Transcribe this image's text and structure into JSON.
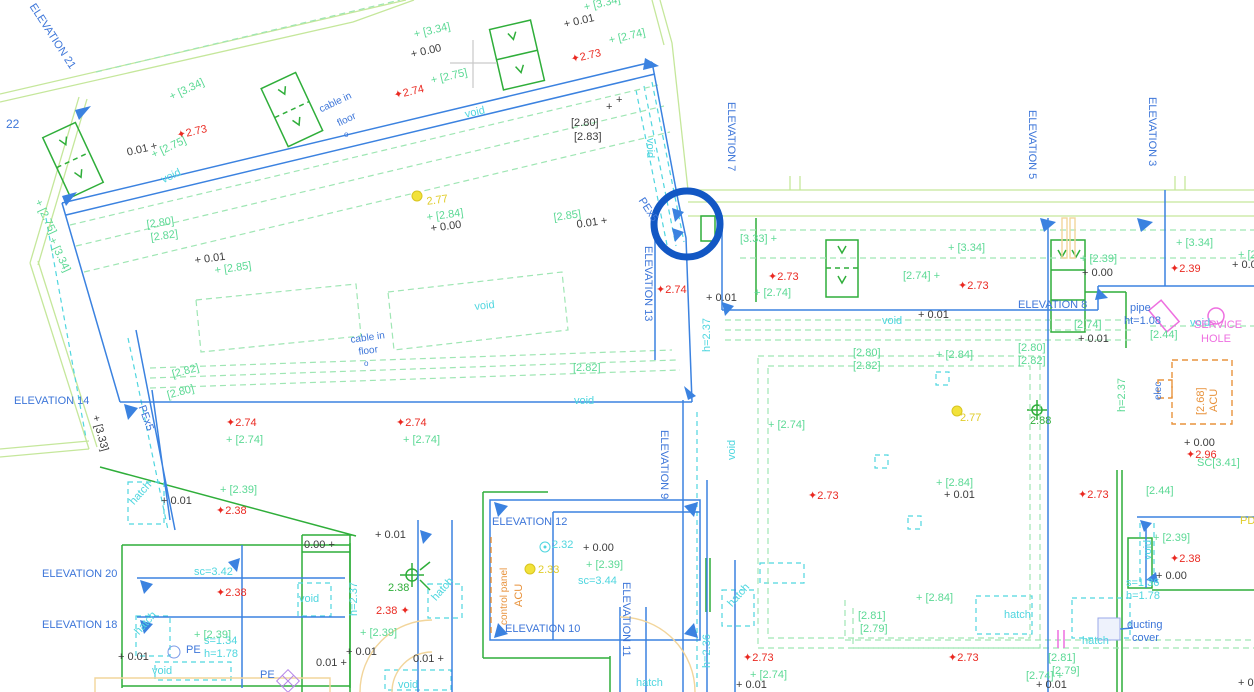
{
  "palette": {
    "blue": "#3d76d9",
    "cyan": "#4fd6df",
    "green": "#5cd995",
    "dgreen": "#2fae3a",
    "red": "#ea2a22",
    "yellow": "#e0cc28",
    "black": "#3c3c3c",
    "orange": "#e8933d",
    "pink": "#ee6fe0",
    "gray": "#c9c9c9",
    "tan": "#f2d59b",
    "wall": "#c5e79b",
    "gdash": "#9fe6b4",
    "line": "#3b82e0",
    "highlight": "#1257c4"
  },
  "drawing": {
    "type": "cad-floor-plan",
    "highlight_circle": {
      "x": 687,
      "y": 224,
      "r": 33,
      "color": "#1257c4",
      "stroke_width": 7
    },
    "labels": [
      {
        "t": "ELEVATION 21",
        "x": 36,
        "y": 2,
        "c": "blue",
        "r": 57
      },
      {
        "t": "22",
        "x": 6,
        "y": 118,
        "c": "blue",
        "s": 12
      },
      {
        "t": "ELEVATION 7",
        "x": 736,
        "y": 102,
        "c": "blue",
        "r": 90
      },
      {
        "t": "ELEVATION 13",
        "x": 653,
        "y": 246,
        "c": "blue",
        "r": 90
      },
      {
        "t": "ELEVATION 14",
        "x": 14,
        "y": 396,
        "c": "blue"
      },
      {
        "t": "ELEVATION 5",
        "x": 1037,
        "y": 110,
        "c": "blue",
        "r": 90
      },
      {
        "t": "ELEVATION 3",
        "x": 1157,
        "y": 97,
        "c": "blue",
        "r": 90
      },
      {
        "t": "ELEVATION 8",
        "x": 1018,
        "y": 300,
        "c": "blue"
      },
      {
        "t": "ELEVATION 9",
        "x": 669,
        "y": 430,
        "c": "blue",
        "r": 90
      },
      {
        "t": "ELEVATION 12",
        "x": 492,
        "y": 517,
        "c": "blue"
      },
      {
        "t": "ELEVATION 11",
        "x": 631,
        "y": 582,
        "c": "blue",
        "r": 90
      },
      {
        "t": "ELEVATION 10",
        "x": 505,
        "y": 624,
        "c": "blue"
      },
      {
        "t": "ELEVATION 20",
        "x": 42,
        "y": 569,
        "c": "blue"
      },
      {
        "t": "ELEVATION 18",
        "x": 42,
        "y": 620,
        "c": "blue"
      },
      {
        "t": "PEx5",
        "x": 645,
        "y": 196,
        "c": "blue",
        "r": 57
      },
      {
        "t": "PEx5",
        "x": 146,
        "y": 404,
        "c": "blue",
        "r": 70
      },
      {
        "t": "pipe",
        "x": 1130,
        "y": 303,
        "c": "blue"
      },
      {
        "t": "ht=1.08",
        "x": 1124,
        "y": 316,
        "c": "blue"
      },
      {
        "t": "cable in",
        "x": 318,
        "y": 106,
        "c": "blue",
        "r": -25,
        "s": 10
      },
      {
        "t": "floor",
        "x": 336,
        "y": 120,
        "c": "blue",
        "r": -25,
        "s": 10
      },
      {
        "t": "o",
        "x": 344,
        "y": 131,
        "c": "blue",
        "s": 8
      },
      {
        "t": "cable in",
        "x": 350,
        "y": 336,
        "c": "blue",
        "r": -8,
        "s": 10
      },
      {
        "t": "floor",
        "x": 358,
        "y": 348,
        "c": "blue",
        "r": -8,
        "s": 10
      },
      {
        "t": "o",
        "x": 364,
        "y": 360,
        "c": "blue",
        "s": 8
      },
      {
        "t": "ducting",
        "x": 1127,
        "y": 620,
        "c": "blue"
      },
      {
        "t": "cover",
        "x": 1132,
        "y": 633,
        "c": "blue"
      },
      {
        "t": "PE",
        "x": 186,
        "y": 645,
        "c": "blue"
      },
      {
        "t": "PE",
        "x": 260,
        "y": 670,
        "c": "blue"
      },
      {
        "t": "elec",
        "x": 1154,
        "y": 400,
        "c": "blue",
        "r": -90,
        "s": 10
      },
      {
        "t": "PD",
        "x": 1240,
        "y": 516,
        "c": "yellow"
      },
      {
        "t": "void",
        "x": 160,
        "y": 176,
        "c": "cyan",
        "r": -25
      },
      {
        "t": "void",
        "x": 464,
        "y": 110,
        "c": "cyan",
        "r": -13
      },
      {
        "t": "void",
        "x": 655,
        "y": 138,
        "c": "cyan",
        "r": 90
      },
      {
        "t": "void",
        "x": 474,
        "y": 302,
        "c": "cyan",
        "r": -6
      },
      {
        "t": "void",
        "x": 574,
        "y": 396,
        "c": "cyan"
      },
      {
        "t": "void",
        "x": 882,
        "y": 316,
        "c": "cyan"
      },
      {
        "t": "void",
        "x": 1190,
        "y": 318,
        "c": "cyan"
      },
      {
        "t": "void",
        "x": 727,
        "y": 460,
        "c": "cyan",
        "r": -90
      },
      {
        "t": "void",
        "x": 299,
        "y": 594,
        "c": "cyan"
      },
      {
        "t": "void",
        "x": 152,
        "y": 666,
        "c": "cyan"
      },
      {
        "t": "void",
        "x": 398,
        "y": 680,
        "c": "cyan"
      },
      {
        "t": "void",
        "x": 1143,
        "y": 560,
        "c": "cyan",
        "r": -90
      },
      {
        "t": "sc=3.42",
        "x": 194,
        "y": 567,
        "c": "cyan"
      },
      {
        "t": "sc=3.44",
        "x": 578,
        "y": 576,
        "c": "cyan"
      },
      {
        "t": "s=1.34",
        "x": 204,
        "y": 636,
        "c": "cyan"
      },
      {
        "t": "h=1.78",
        "x": 204,
        "y": 649,
        "c": "cyan"
      },
      {
        "t": "s=1.36",
        "x": 1126,
        "y": 578,
        "c": "cyan"
      },
      {
        "t": "h=1.78",
        "x": 1126,
        "y": 591,
        "c": "cyan"
      },
      {
        "t": "h=2.37",
        "x": 349,
        "y": 616,
        "c": "cyan",
        "r": -90
      },
      {
        "t": "h=2.37",
        "x": 702,
        "y": 352,
        "c": "cyan",
        "r": -90
      },
      {
        "t": "h=2.36",
        "x": 702,
        "y": 668,
        "c": "cyan",
        "r": -90
      },
      {
        "t": "h=2.37",
        "x": 1117,
        "y": 412,
        "c": "green",
        "r": -90
      },
      {
        "t": "hatch",
        "x": 128,
        "y": 500,
        "c": "cyan",
        "r": -48
      },
      {
        "t": "hatch",
        "x": 133,
        "y": 630,
        "c": "cyan",
        "r": -48
      },
      {
        "t": "hatch",
        "x": 430,
        "y": 596,
        "c": "cyan",
        "r": -48
      },
      {
        "t": "hatch",
        "x": 726,
        "y": 602,
        "c": "cyan",
        "r": -48
      },
      {
        "t": "hatch",
        "x": 1004,
        "y": 610,
        "c": "cyan"
      },
      {
        "t": "hatch",
        "x": 1082,
        "y": 636,
        "c": "cyan"
      },
      {
        "t": "hatch",
        "x": 636,
        "y": 678,
        "c": "cyan"
      },
      {
        "t": "2.32",
        "x": 552,
        "y": 540,
        "c": "cyan"
      },
      {
        "t": "+ [3.34]",
        "x": 168,
        "y": 93,
        "c": "green",
        "r": -25
      },
      {
        "t": "+ [2.75]",
        "x": 150,
        "y": 151,
        "c": "green",
        "r": -25
      },
      {
        "t": "+ [3.34]",
        "x": 413,
        "y": 30,
        "c": "green",
        "r": -13
      },
      {
        "t": "+ [2.75]",
        "x": 430,
        "y": 76,
        "c": "green",
        "r": -13
      },
      {
        "t": "+ [3.34]",
        "x": 583,
        "y": 3,
        "c": "green",
        "r": -13
      },
      {
        "t": "+ [2.74]",
        "x": 608,
        "y": 36,
        "c": "green",
        "r": -13
      },
      {
        "t": "+ [2.75]",
        "x": 42,
        "y": 198,
        "c": "green",
        "r": 65
      },
      {
        "t": "+ [3.34]",
        "x": 56,
        "y": 236,
        "c": "green",
        "r": 65
      },
      {
        "t": "[2.80]",
        "x": 146,
        "y": 220,
        "c": "green",
        "r": -8
      },
      {
        "t": "[2.82]",
        "x": 150,
        "y": 233,
        "c": "green",
        "r": -8
      },
      {
        "t": "+ [2.85]",
        "x": 214,
        "y": 266,
        "c": "green",
        "r": -8
      },
      {
        "t": "+ [2.84]",
        "x": 426,
        "y": 213,
        "c": "green",
        "r": -8
      },
      {
        "t": "[2.85]",
        "x": 553,
        "y": 213,
        "c": "green",
        "r": -8
      },
      {
        "t": "[2.82]",
        "x": 171,
        "y": 370,
        "c": "green",
        "r": -15
      },
      {
        "t": "[2.80]",
        "x": 166,
        "y": 391,
        "c": "green",
        "r": -15
      },
      {
        "t": "[2.82]",
        "x": 573,
        "y": 363,
        "c": "green"
      },
      {
        "t": "+ [2.74]",
        "x": 226,
        "y": 435,
        "c": "green"
      },
      {
        "t": "+ [2.74]",
        "x": 403,
        "y": 435,
        "c": "green"
      },
      {
        "t": "+ [2.39]",
        "x": 220,
        "y": 485,
        "c": "green"
      },
      {
        "t": "+ [2.39]",
        "x": 360,
        "y": 628,
        "c": "green"
      },
      {
        "t": "+ [2.39]",
        "x": 194,
        "y": 630,
        "c": "green"
      },
      {
        "t": "+ [2.39]",
        "x": 586,
        "y": 560,
        "c": "green"
      },
      {
        "t": "[3.33] +",
        "x": 740,
        "y": 234,
        "c": "green"
      },
      {
        "t": "+ [3.34]",
        "x": 948,
        "y": 243,
        "c": "green"
      },
      {
        "t": "+ [3.34]",
        "x": 1176,
        "y": 238,
        "c": "green"
      },
      {
        "t": "[2.74] +",
        "x": 903,
        "y": 271,
        "c": "green"
      },
      {
        "t": "+ [2.74]",
        "x": 754,
        "y": 288,
        "c": "green"
      },
      {
        "t": "+ [2.39]",
        "x": 1080,
        "y": 254,
        "c": "green"
      },
      {
        "t": "[2.74]",
        "x": 1074,
        "y": 320,
        "c": "green"
      },
      {
        "t": "[2.80]",
        "x": 853,
        "y": 348,
        "c": "green"
      },
      {
        "t": "[2.82]",
        "x": 853,
        "y": 361,
        "c": "green"
      },
      {
        "t": "[2.80]",
        "x": 1018,
        "y": 343,
        "c": "green"
      },
      {
        "t": "[2.82]",
        "x": 1018,
        "y": 356,
        "c": "green"
      },
      {
        "t": "+ [2.84]",
        "x": 936,
        "y": 350,
        "c": "green"
      },
      {
        "t": "+ [2.74]",
        "x": 768,
        "y": 420,
        "c": "green"
      },
      {
        "t": "+ [2.84]",
        "x": 936,
        "y": 478,
        "c": "green"
      },
      {
        "t": "+ [2.84]",
        "x": 916,
        "y": 593,
        "c": "green"
      },
      {
        "t": "[2.81]",
        "x": 858,
        "y": 611,
        "c": "green"
      },
      {
        "t": "[2.79]",
        "x": 860,
        "y": 624,
        "c": "green"
      },
      {
        "t": "+ [2.74]",
        "x": 750,
        "y": 670,
        "c": "green"
      },
      {
        "t": "[2.74] +",
        "x": 1026,
        "y": 671,
        "c": "green"
      },
      {
        "t": "[2.44]",
        "x": 1150,
        "y": 330,
        "c": "green"
      },
      {
        "t": "[2.44]",
        "x": 1146,
        "y": 486,
        "c": "green"
      },
      {
        "t": "SC[3.41]",
        "x": 1197,
        "y": 458,
        "c": "green"
      },
      {
        "t": "[2.81]",
        "x": 1048,
        "y": 653,
        "c": "green"
      },
      {
        "t": "[2.79]",
        "x": 1052,
        "y": 666,
        "c": "green"
      },
      {
        "t": "+ [2.39]",
        "x": 1153,
        "y": 533,
        "c": "green"
      },
      {
        "t": "+ [2",
        "x": 1238,
        "y": 250,
        "c": "green"
      },
      {
        "t": "2.38",
        "x": 388,
        "y": 583,
        "c": "dgreen"
      },
      {
        "t": "2.88",
        "x": 1030,
        "y": 416,
        "c": "dgreen"
      },
      {
        "t": "0.01 +",
        "x": 126,
        "y": 148,
        "c": "black",
        "r": -13
      },
      {
        "t": "+ 0.00",
        "x": 410,
        "y": 50,
        "c": "black",
        "r": -13
      },
      {
        "t": "+ 0.01",
        "x": 563,
        "y": 20,
        "c": "black",
        "r": -13
      },
      {
        "t": "+ 0.01",
        "x": 194,
        "y": 256,
        "c": "black",
        "r": -8
      },
      {
        "t": "+ 0.00",
        "x": 430,
        "y": 224,
        "c": "black",
        "r": -8
      },
      {
        "t": "0.01 +",
        "x": 576,
        "y": 220,
        "c": "black",
        "r": -8
      },
      {
        "t": "[2.80]",
        "x": 571,
        "y": 118,
        "c": "black"
      },
      {
        "t": "[2.83]",
        "x": 574,
        "y": 132,
        "c": "black"
      },
      {
        "t": "+",
        "x": 606,
        "y": 102,
        "c": "black"
      },
      {
        "t": "+",
        "x": 616,
        "y": 95,
        "c": "black"
      },
      {
        "t": "+ [3.33]",
        "x": 100,
        "y": 414,
        "c": "black",
        "r": 75
      },
      {
        "t": "+ 0.01",
        "x": 161,
        "y": 496,
        "c": "black"
      },
      {
        "t": "+ 0.01",
        "x": 706,
        "y": 293,
        "c": "black"
      },
      {
        "t": "+ 0.01",
        "x": 918,
        "y": 310,
        "c": "black"
      },
      {
        "t": "+ 0.01",
        "x": 1078,
        "y": 334,
        "c": "black"
      },
      {
        "t": "+ 0.00",
        "x": 1082,
        "y": 268,
        "c": "black"
      },
      {
        "t": "+ 0.0",
        "x": 1232,
        "y": 260,
        "c": "black"
      },
      {
        "t": "+ 0.00",
        "x": 1184,
        "y": 438,
        "c": "black"
      },
      {
        "t": "+ 0.01",
        "x": 944,
        "y": 490,
        "c": "black"
      },
      {
        "t": "+ 0.01",
        "x": 375,
        "y": 530,
        "c": "black"
      },
      {
        "t": "0.00 +",
        "x": 304,
        "y": 540,
        "c": "black"
      },
      {
        "t": "+ 0.00",
        "x": 583,
        "y": 543,
        "c": "black"
      },
      {
        "t": "+ 0.01",
        "x": 346,
        "y": 647,
        "c": "black"
      },
      {
        "t": "0.01 +",
        "x": 413,
        "y": 654,
        "c": "black"
      },
      {
        "t": "0.01 +",
        "x": 316,
        "y": 658,
        "c": "black"
      },
      {
        "t": "+ 0.01",
        "x": 118,
        "y": 652,
        "c": "black"
      },
      {
        "t": "+ 0.01",
        "x": 736,
        "y": 680,
        "c": "black"
      },
      {
        "t": "+ 0.01",
        "x": 1036,
        "y": 680,
        "c": "black"
      },
      {
        "t": "+ 0.00",
        "x": 1156,
        "y": 571,
        "c": "black"
      },
      {
        "t": "+ 0.0",
        "x": 1238,
        "y": 678,
        "c": "black"
      },
      {
        "t": "✦2.73",
        "x": 176,
        "y": 131,
        "c": "red",
        "r": -13
      },
      {
        "t": "✦2.74",
        "x": 393,
        "y": 91,
        "c": "red",
        "r": -13
      },
      {
        "t": "✦2.73",
        "x": 570,
        "y": 55,
        "c": "red",
        "r": -13
      },
      {
        "t": "✦2.74",
        "x": 226,
        "y": 418,
        "c": "red"
      },
      {
        "t": "✦2.74",
        "x": 396,
        "y": 418,
        "c": "red"
      },
      {
        "t": "✦2.38",
        "x": 216,
        "y": 506,
        "c": "red"
      },
      {
        "t": "✦2.38",
        "x": 216,
        "y": 588,
        "c": "red"
      },
      {
        "t": "2.38 ✦",
        "x": 376,
        "y": 606,
        "c": "red"
      },
      {
        "t": "✦2.74",
        "x": 656,
        "y": 285,
        "c": "red"
      },
      {
        "t": "✦2.73",
        "x": 768,
        "y": 272,
        "c": "red"
      },
      {
        "t": "✦2.73",
        "x": 958,
        "y": 281,
        "c": "red"
      },
      {
        "t": "✦2.39",
        "x": 1170,
        "y": 264,
        "c": "red"
      },
      {
        "t": "✦2.73",
        "x": 808,
        "y": 491,
        "c": "red"
      },
      {
        "t": "✦2.73",
        "x": 1078,
        "y": 490,
        "c": "red"
      },
      {
        "t": "✦2.96",
        "x": 1186,
        "y": 450,
        "c": "red"
      },
      {
        "t": "✦2.38",
        "x": 1170,
        "y": 554,
        "c": "red"
      },
      {
        "t": "✦2.73",
        "x": 743,
        "y": 653,
        "c": "red"
      },
      {
        "t": "✦2.73",
        "x": 948,
        "y": 653,
        "c": "red"
      },
      {
        "t": "2.77",
        "x": 426,
        "y": 197,
        "c": "yellow",
        "r": -8
      },
      {
        "t": "2.77",
        "x": 960,
        "y": 413,
        "c": "yellow"
      },
      {
        "t": "2.33",
        "x": 538,
        "y": 565,
        "c": "yellow"
      },
      {
        "t": "SERVICE",
        "x": 1194,
        "y": 320,
        "c": "pink"
      },
      {
        "t": "HOLE",
        "x": 1201,
        "y": 334,
        "c": "pink"
      },
      {
        "t": "ACU",
        "x": 1209,
        "y": 412,
        "c": "orange",
        "r": -90
      },
      {
        "t": "[2.68]",
        "x": 1196,
        "y": 415,
        "c": "orange",
        "r": -90
      },
      {
        "t": "ACU",
        "x": 514,
        "y": 607,
        "c": "orange",
        "r": -90
      },
      {
        "t": "control panel",
        "x": 500,
        "y": 625,
        "c": "orange",
        "r": -90,
        "s": 10
      }
    ]
  }
}
